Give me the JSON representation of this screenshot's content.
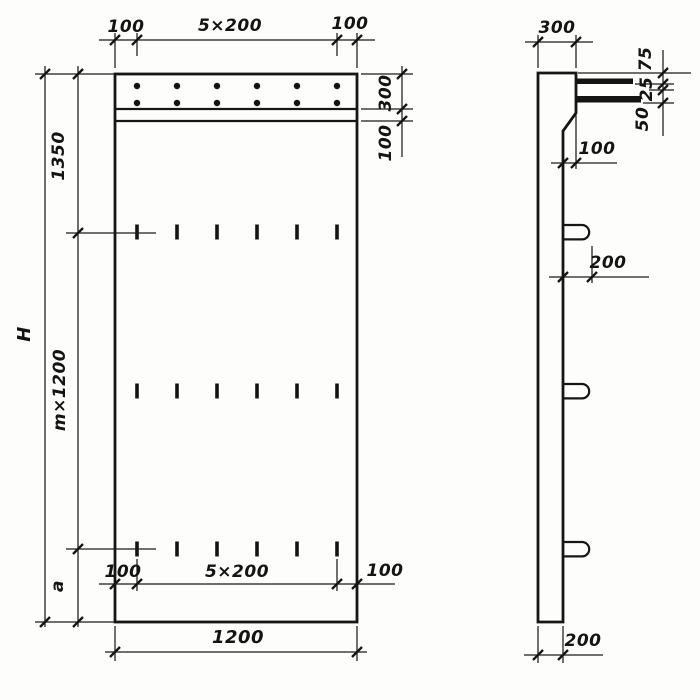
{
  "front_view": {
    "top": {
      "left": "100",
      "center": "5×200",
      "right": "100"
    },
    "right": {
      "band": "300",
      "sub_band": "100"
    },
    "left": {
      "upper": "1350",
      "module": "m×1200",
      "bottom": "a",
      "overall": "H"
    },
    "bottom_inner": {
      "left": "100",
      "center": "5×200",
      "right": "100"
    },
    "bottom": {
      "width": "1200"
    }
  },
  "side_view": {
    "top": {
      "width": "300"
    },
    "right_chain": {
      "d1": "75",
      "d2": "25",
      "d3": "50"
    },
    "step": "100",
    "loop": "200",
    "base": "200"
  }
}
